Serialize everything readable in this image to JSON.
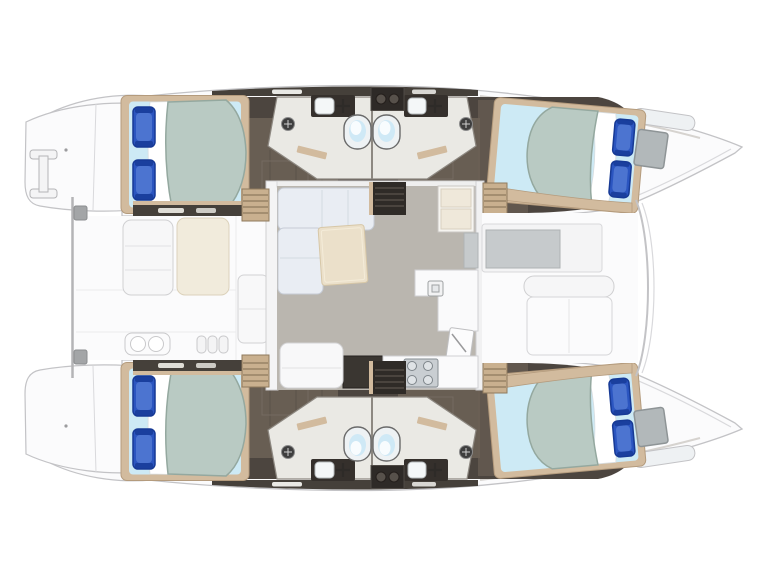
{
  "description": "Top-down floor plan of a sailing catamaran: two hulls (bows pointing right, transom swim platforms left), each hull with an aft double cabin, two private bathrooms amidships and a forward double cabin; central bridgedeck salon with L-shaped sofa, table and galley (sink, 4-burner stove, fridge); aft cockpit with bench seats and forward cockpit with lounge seat between the bows.",
  "vessel": {
    "layout": "4 cabins / 4 heads catamaran",
    "orientation": "bow-right, stern-left",
    "features": {
      "cabins": [
        "aft-port-cabin",
        "forward-port-cabin",
        "aft-starboard-cabin",
        "forward-starboard-cabin"
      ],
      "berths_per_cabin": "double berth with 2 blue pillows, sage duvet, light-blue sheet",
      "bathrooms": [
        "port-aft-head",
        "port-forward-head",
        "starboard-aft-head",
        "starboard-forward-head"
      ],
      "bathroom_fixtures": [
        "toilet",
        "vanity-sink-with-faucet",
        "shower-head"
      ],
      "salon": [
        "l-shaped-sofa",
        "cocktail-table",
        "galley-counter",
        "galley-sink",
        "stove-4-burner",
        "fridge-cabinet",
        "forward-door"
      ],
      "aft-cockpit": [
        "bench-seat-white",
        "bench-seat-cream",
        "davit-bar",
        "double-sink-module",
        "step-cushions"
      ],
      "forward-cockpit": [
        "anchor-locker",
        "forward-bench-seat"
      ],
      "transoms": [
        "port-swim-platform",
        "starboard-swim-platform",
        "mooring-cleat"
      ],
      "companionways": [
        "aft-steps",
        "forward-steps",
        "dark-companionway"
      ]
    }
  },
  "colors": {
    "bg": "#ffffff",
    "deck": "#fbfbfc",
    "line": "#c3c3c6",
    "line2": "#d9d9dc",
    "hullband": "#45403a",
    "floorDark": "#4c453f",
    "floorWood": "#6b6055",
    "wood": "#d2bb9e",
    "woodEdge": "#b49b7d",
    "stepTan": "#c9b08f",
    "stepLine": "#8f7a5d",
    "sheet": "#cdeaf5",
    "duvet": "#b9cac3",
    "duvetEdge": "#94a89f",
    "pillow": "#2b55c0",
    "pillowDark": "#173a95",
    "pillowLight": "#6e93e0",
    "bathFloor": "#eae9e4",
    "bathEdge": "#8d8881",
    "vanity": "#35302c",
    "toiletBowl": "#cfe9f6",
    "hatch": "#b2b8ba",
    "salonFloor": "#bab6af",
    "sofa": "#e9edf3",
    "sofaEdge": "#c6ccd6",
    "table": "#ebe0ca",
    "tableEdge": "#d7c7a7",
    "counter": "#fafafb",
    "counterEdge": "#d0d0d3",
    "stove": "#c9ced2",
    "stoveEdge": "#878e93",
    "cushionCream": "#f1ebdc",
    "creamEdge": "#dcd2bb",
    "grayPanel": "#c6cacc",
    "davit": "#b4b4b6",
    "darkCabinet": "#3a3631",
    "companionway": "#2f2b27"
  }
}
